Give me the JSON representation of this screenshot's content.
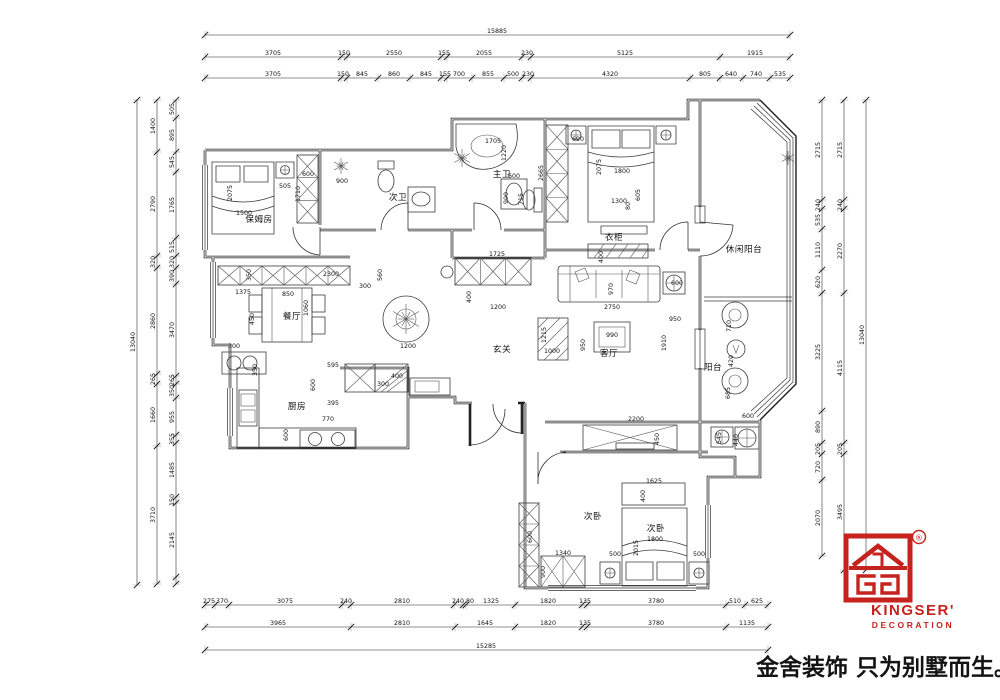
{
  "colors": {
    "brand_red": "#c6221e",
    "line": "#1c1c1c"
  },
  "logo": {
    "brand": "KINGSER'",
    "sub": "DECORATION",
    "reg": "®",
    "slogan": "金舍装饰 只为别墅而生。"
  },
  "rooms": [
    {
      "t": "保姆房",
      "x": 259,
      "y": 222
    },
    {
      "t": "次卫",
      "x": 398,
      "y": 200
    },
    {
      "t": "主卫",
      "x": 502,
      "y": 177
    },
    {
      "t": "休闲阳台",
      "x": 744,
      "y": 252
    },
    {
      "t": "衣柜",
      "x": 614,
      "y": 240
    },
    {
      "t": "玄关",
      "x": 502,
      "y": 352
    },
    {
      "t": "客厅",
      "x": 609,
      "y": 356
    },
    {
      "t": "餐厅",
      "x": 292,
      "y": 319
    },
    {
      "t": "厨房",
      "x": 297,
      "y": 409
    },
    {
      "t": "阳台",
      "x": 713,
      "y": 370
    },
    {
      "t": "次卧",
      "x": 593,
      "y": 519
    },
    {
      "t": "次卧",
      "x": 656,
      "y": 531
    }
  ],
  "dims": {
    "h_rows": [
      {
        "y": 35,
        "x1": 205,
        "x2": 790,
        "ticks": [
          205,
          790
        ],
        "labels": [
          {
            "t": "15885",
            "x": 497
          }
        ]
      },
      {
        "y": 57,
        "x1": 205,
        "x2": 790,
        "ticks": [
          205,
          341,
          347,
          441,
          447,
          522,
          531,
          720,
          790
        ],
        "labels": [
          {
            "t": "3705",
            "x": 273
          },
          {
            "t": "150",
            "x": 344
          },
          {
            "t": "2550",
            "x": 394
          },
          {
            "t": "155",
            "x": 444
          },
          {
            "t": "2055",
            "x": 484
          },
          {
            "t": "230",
            "x": 527
          },
          {
            "t": "5125",
            "x": 625
          },
          {
            "t": "1915",
            "x": 755
          }
        ]
      },
      {
        "y": 78,
        "x1": 205,
        "x2": 790,
        "ticks": [
          205,
          341,
          347,
          378,
          410,
          441,
          447,
          472,
          504,
          522,
          531,
          690,
          720,
          743,
          770,
          790
        ],
        "labels": [
          {
            "t": "3705",
            "x": 273
          },
          {
            "t": "150",
            "x": 343
          },
          {
            "t": "845",
            "x": 362
          },
          {
            "t": "860",
            "x": 394
          },
          {
            "t": "845",
            "x": 426
          },
          {
            "t": "155",
            "x": 445
          },
          {
            "t": "700",
            "x": 459
          },
          {
            "t": "855",
            "x": 488
          },
          {
            "t": "500",
            "x": 513
          },
          {
            "t": "230",
            "x": 528
          },
          {
            "t": "4320",
            "x": 610
          },
          {
            "t": "805",
            "x": 705
          },
          {
            "t": "640",
            "x": 731
          },
          {
            "t": "740",
            "x": 756
          },
          {
            "t": "535",
            "x": 780
          }
        ]
      },
      {
        "y": 605,
        "x1": 205,
        "x2": 768,
        "ticks": [
          205,
          215,
          229,
          342,
          351,
          454,
          463,
          466,
          515,
          582,
          587,
          726,
          745,
          768
        ],
        "labels": [
          {
            "t": "275",
            "x": 209
          },
          {
            "t": "370",
            "x": 222
          },
          {
            "t": "3075",
            "x": 285
          },
          {
            "t": "240",
            "x": 346
          },
          {
            "t": "2810",
            "x": 402
          },
          {
            "t": "240",
            "x": 458
          },
          {
            "t": "80",
            "x": 470
          },
          {
            "t": "1325",
            "x": 491
          },
          {
            "t": "1820",
            "x": 548
          },
          {
            "t": "135",
            "x": 585
          },
          {
            "t": "3780",
            "x": 656
          },
          {
            "t": "510",
            "x": 735
          },
          {
            "t": "625",
            "x": 757
          }
        ]
      },
      {
        "y": 627,
        "x1": 205,
        "x2": 768,
        "ticks": [
          205,
          351,
          455,
          515,
          582,
          587,
          726,
          768
        ],
        "labels": [
          {
            "t": "3965",
            "x": 278
          },
          {
            "t": "2810",
            "x": 402
          },
          {
            "t": "1645",
            "x": 485
          },
          {
            "t": "1820",
            "x": 548
          },
          {
            "t": "135",
            "x": 585
          },
          {
            "t": "3780",
            "x": 656
          },
          {
            "t": "1135",
            "x": 747
          }
        ]
      },
      {
        "y": 650,
        "x1": 205,
        "x2": 768,
        "ticks": [
          205,
          768
        ],
        "labels": [
          {
            "t": "15285",
            "x": 486
          }
        ]
      }
    ],
    "v_rows": [
      {
        "x": 137,
        "y1": 100,
        "y2": 585,
        "ticks": [
          100,
          585
        ],
        "labels": [
          {
            "t": "13040",
            "y": 342
          }
        ]
      },
      {
        "x": 157,
        "y1": 100,
        "y2": 584,
        "ticks": [
          100,
          152,
          256,
          268,
          374,
          384,
          446,
          584
        ],
        "labels": [
          {
            "t": "1400",
            "y": 126
          },
          {
            "t": "2790",
            "y": 204
          },
          {
            "t": "320",
            "y": 262
          },
          {
            "t": "2860",
            "y": 321
          },
          {
            "t": "265",
            "y": 379
          },
          {
            "t": "1660",
            "y": 415
          },
          {
            "t": "3710",
            "y": 515
          }
        ]
      },
      {
        "x": 176,
        "y1": 100,
        "y2": 584,
        "ticks": [
          100,
          118,
          152,
          172,
          238,
          256,
          268,
          284,
          376,
          384,
          398,
          435,
          443,
          497,
          503,
          577,
          584
        ],
        "labels": [
          {
            "t": "505",
            "y": 109
          },
          {
            "t": "895",
            "y": 135
          },
          {
            "t": "545",
            "y": 162
          },
          {
            "t": "1765",
            "y": 205
          },
          {
            "t": "515",
            "y": 247
          },
          {
            "t": "320",
            "y": 262
          },
          {
            "t": "390",
            "y": 276
          },
          {
            "t": "3470",
            "y": 330
          },
          {
            "t": "265",
            "y": 380
          },
          {
            "t": "350",
            "y": 391
          },
          {
            "t": "955",
            "y": 417
          },
          {
            "t": "355",
            "y": 439
          },
          {
            "t": "1485",
            "y": 470
          },
          {
            "t": "150",
            "y": 500
          },
          {
            "t": "2145",
            "y": 540
          }
        ]
      },
      {
        "x": 822,
        "y1": 100,
        "y2": 556,
        "ticks": [
          100,
          200,
          209,
          229,
          270,
          293,
          411,
          443,
          454,
          480,
          556
        ],
        "labels": [
          {
            "t": "2715",
            "y": 150
          },
          {
            "t": "240",
            "y": 205
          },
          {
            "t": "535",
            "y": 220
          },
          {
            "t": "1110",
            "y": 250
          },
          {
            "t": "620",
            "y": 282
          },
          {
            "t": "3225",
            "y": 352
          },
          {
            "t": "890",
            "y": 427
          },
          {
            "t": "205",
            "y": 449
          },
          {
            "t": "720",
            "y": 467
          },
          {
            "t": "2070",
            "y": 518
          }
        ]
      },
      {
        "x": 844,
        "y1": 100,
        "y2": 570,
        "ticks": [
          100,
          200,
          209,
          293,
          443,
          454,
          570
        ],
        "labels": [
          {
            "t": "2715",
            "y": 150
          },
          {
            "t": "240",
            "y": 205
          },
          {
            "t": "2270",
            "y": 251
          },
          {
            "t": "4115",
            "y": 368
          },
          {
            "t": "205",
            "y": 449
          },
          {
            "t": "3495",
            "y": 512
          }
        ]
      },
      {
        "x": 866,
        "y1": 100,
        "y2": 570,
        "ticks": [
          100,
          570
        ],
        "labels": [
          {
            "t": "13040",
            "y": 335
          }
        ]
      }
    ],
    "interior": [
      {
        "t": "1500",
        "x": 244,
        "y": 215
      },
      {
        "t": "2075",
        "x": 232,
        "y": 193,
        "r": 1
      },
      {
        "t": "505",
        "x": 285,
        "y": 188
      },
      {
        "t": "600",
        "x": 308,
        "y": 176
      },
      {
        "t": "1710",
        "x": 300,
        "y": 194,
        "r": 1
      },
      {
        "t": "900",
        "x": 342,
        "y": 183
      },
      {
        "t": "1705",
        "x": 493,
        "y": 143
      },
      {
        "t": "1220",
        "x": 506,
        "y": 153,
        "r": 1
      },
      {
        "t": "600",
        "x": 514,
        "y": 178
      },
      {
        "t": "900",
        "x": 508,
        "y": 198,
        "r": 1
      },
      {
        "t": "715",
        "x": 523,
        "y": 199,
        "r": 1
      },
      {
        "t": "2665",
        "x": 543,
        "y": 173,
        "r": 1
      },
      {
        "t": "605",
        "x": 640,
        "y": 195,
        "r": 1
      },
      {
        "t": "690",
        "x": 578,
        "y": 141
      },
      {
        "t": "2075",
        "x": 601,
        "y": 167,
        "r": 1
      },
      {
        "t": "1800",
        "x": 622,
        "y": 173
      },
      {
        "t": "1300",
        "x": 619,
        "y": 203
      },
      {
        "t": "80",
        "x": 630,
        "y": 206,
        "r": 1
      },
      {
        "t": "1725",
        "x": 497,
        "y": 256
      },
      {
        "t": "560",
        "x": 382,
        "y": 275,
        "r": 1
      },
      {
        "t": "300",
        "x": 365,
        "y": 288
      },
      {
        "t": "400",
        "x": 471,
        "y": 297,
        "r": 1
      },
      {
        "t": "1200",
        "x": 498,
        "y": 309
      },
      {
        "t": "1375",
        "x": 243,
        "y": 294
      },
      {
        "t": "2300",
        "x": 331,
        "y": 276
      },
      {
        "t": "350",
        "x": 251,
        "y": 275,
        "r": 1
      },
      {
        "t": "850",
        "x": 288,
        "y": 296
      },
      {
        "t": "450",
        "x": 254,
        "y": 319,
        "r": 1
      },
      {
        "t": "1060",
        "x": 308,
        "y": 308,
        "r": 1
      },
      {
        "t": "1200",
        "x": 408,
        "y": 348
      },
      {
        "t": "300",
        "x": 234,
        "y": 348
      },
      {
        "t": "350",
        "x": 257,
        "y": 370,
        "r": 1
      },
      {
        "t": "595",
        "x": 333,
        "y": 367
      },
      {
        "t": "600",
        "x": 315,
        "y": 385,
        "r": 1
      },
      {
        "t": "395",
        "x": 333,
        "y": 405
      },
      {
        "t": "770",
        "x": 328,
        "y": 421
      },
      {
        "t": "600",
        "x": 288,
        "y": 435,
        "r": 1
      },
      {
        "t": "400",
        "x": 397,
        "y": 378
      },
      {
        "t": "300",
        "x": 383,
        "y": 386
      },
      {
        "t": "1215",
        "x": 546,
        "y": 335,
        "r": 1
      },
      {
        "t": "1000",
        "x": 552,
        "y": 353
      },
      {
        "t": "2750",
        "x": 612,
        "y": 309
      },
      {
        "t": "970",
        "x": 613,
        "y": 289,
        "r": 1
      },
      {
        "t": "600",
        "x": 677,
        "y": 285
      },
      {
        "t": "950",
        "x": 675,
        "y": 321
      },
      {
        "t": "1910",
        "x": 666,
        "y": 343,
        "r": 1
      },
      {
        "t": "990",
        "x": 612,
        "y": 337
      },
      {
        "t": "950",
        "x": 585,
        "y": 345,
        "r": 1
      },
      {
        "t": "400",
        "x": 603,
        "y": 257,
        "r": 1
      },
      {
        "t": "710",
        "x": 731,
        "y": 326,
        "r": 1
      },
      {
        "t": "420",
        "x": 733,
        "y": 361,
        "r": 1
      },
      {
        "t": "685",
        "x": 730,
        "y": 393,
        "r": 1
      },
      {
        "t": "600",
        "x": 748,
        "y": 418
      },
      {
        "t": "440",
        "x": 738,
        "y": 440,
        "r": 1
      },
      {
        "t": "545",
        "x": 721,
        "y": 438,
        "r": 1
      },
      {
        "t": "2200",
        "x": 636,
        "y": 421
      },
      {
        "t": "450",
        "x": 659,
        "y": 439,
        "r": 1
      },
      {
        "t": "1625",
        "x": 654,
        "y": 483
      },
      {
        "t": "400",
        "x": 645,
        "y": 496,
        "r": 1
      },
      {
        "t": "1800",
        "x": 655,
        "y": 541
      },
      {
        "t": "2015",
        "x": 638,
        "y": 548,
        "r": 1
      },
      {
        "t": "500",
        "x": 615,
        "y": 556
      },
      {
        "t": "500",
        "x": 699,
        "y": 556
      },
      {
        "t": "1340",
        "x": 563,
        "y": 555
      },
      {
        "t": "900",
        "x": 545,
        "y": 572,
        "r": 1
      },
      {
        "t": "600",
        "x": 532,
        "y": 537,
        "r": 1
      }
    ]
  }
}
